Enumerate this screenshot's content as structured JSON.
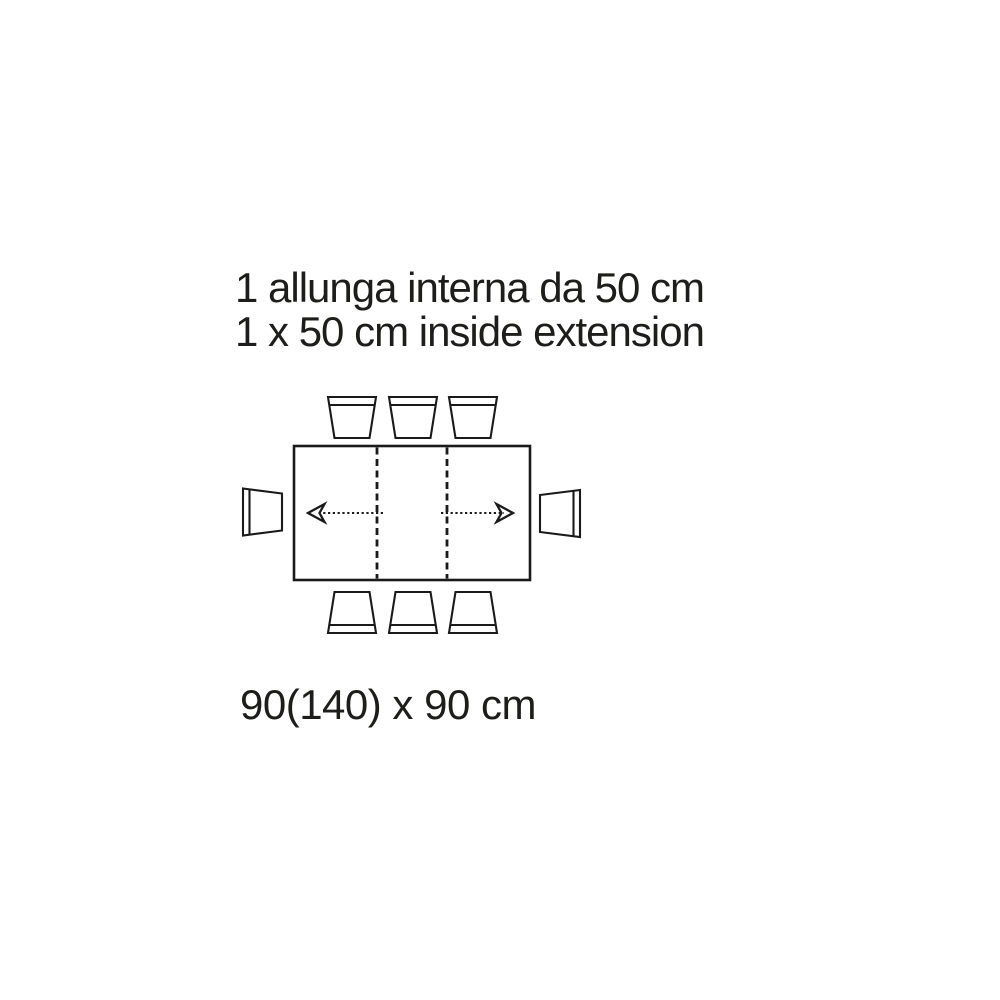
{
  "colors": {
    "line": "#1a1a1a",
    "text": "#1d1d1b",
    "background": "#ffffff"
  },
  "captions": {
    "italian": "1 allunga interna da 50 cm",
    "english": "1 x 50 cm inside extension"
  },
  "dimension_label": "90(140) x 90 cm",
  "diagram": {
    "type": "extendable-table-top-view",
    "chairs_top": 3,
    "chairs_bottom": 3,
    "chairs_left": 1,
    "chairs_right": 1,
    "extension_leaves": 1
  }
}
